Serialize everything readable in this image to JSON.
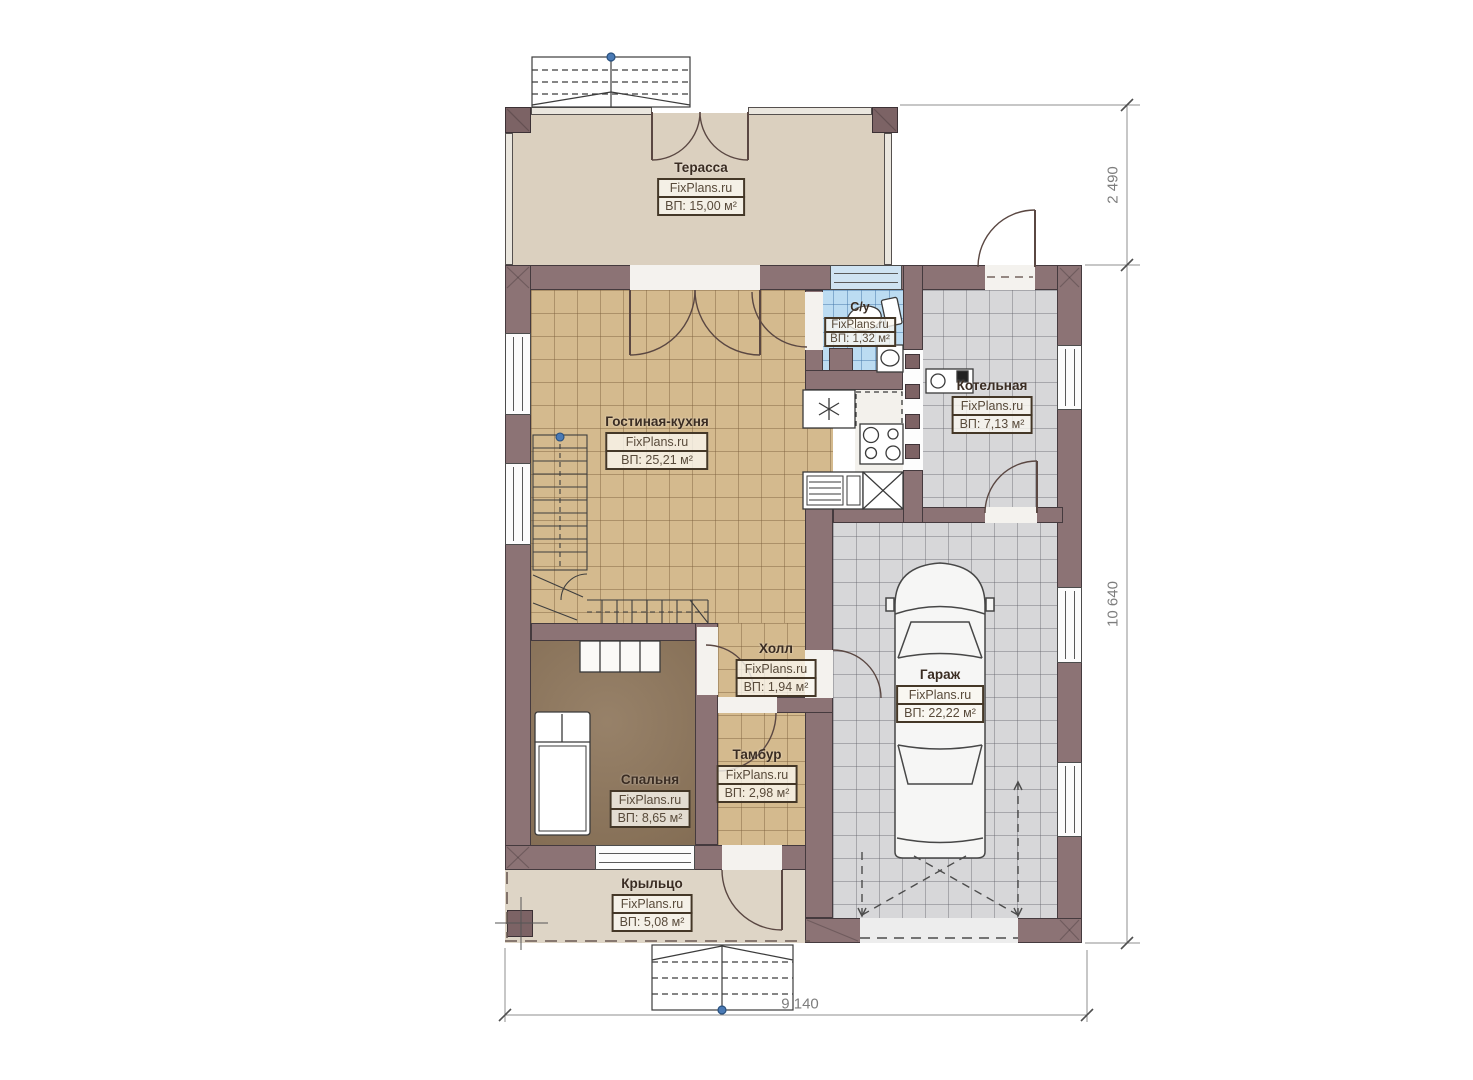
{
  "plan": {
    "watermark": "FixPlans.ru",
    "rooms": [
      {
        "id": "terrace",
        "name": "Терасса",
        "area": "ВП: 15,00 м²"
      },
      {
        "id": "living-kitchen",
        "name": "Гостиная-кухня",
        "area": "ВП: 25,21 м²"
      },
      {
        "id": "bathroom",
        "name": "С/у",
        "area": "ВП: 1,32 м²"
      },
      {
        "id": "boiler-room",
        "name": "Котельная",
        "area": "ВП: 7,13 м²"
      },
      {
        "id": "hall",
        "name": "Холл",
        "area": "ВП: 1,94 м²"
      },
      {
        "id": "vestibule",
        "name": "Тамбур",
        "area": "ВП: 2,98 м²"
      },
      {
        "id": "bedroom",
        "name": "Спальня",
        "area": "ВП: 8,65 м²"
      },
      {
        "id": "garage",
        "name": "Гараж",
        "area": "ВП: 22,22 м²"
      },
      {
        "id": "porch",
        "name": "Крыльцо",
        "area": "ВП: 5,08 м²"
      }
    ],
    "dimensions": {
      "right_upper": "2 490",
      "right_lower": "10 640",
      "bottom": "9 140"
    },
    "colors": {
      "wall": "#8c7375",
      "floor_tan_tile": "#d4ba8e",
      "floor_bedroom": "#8d755a",
      "floor_bath_tile": "#bcdcf2",
      "floor_gray_tile": "#d7d7d9",
      "floor_terrace": "#dbd0bf",
      "floor_porch": "#ded5c6",
      "level_marker": "#4a7ab5"
    }
  }
}
